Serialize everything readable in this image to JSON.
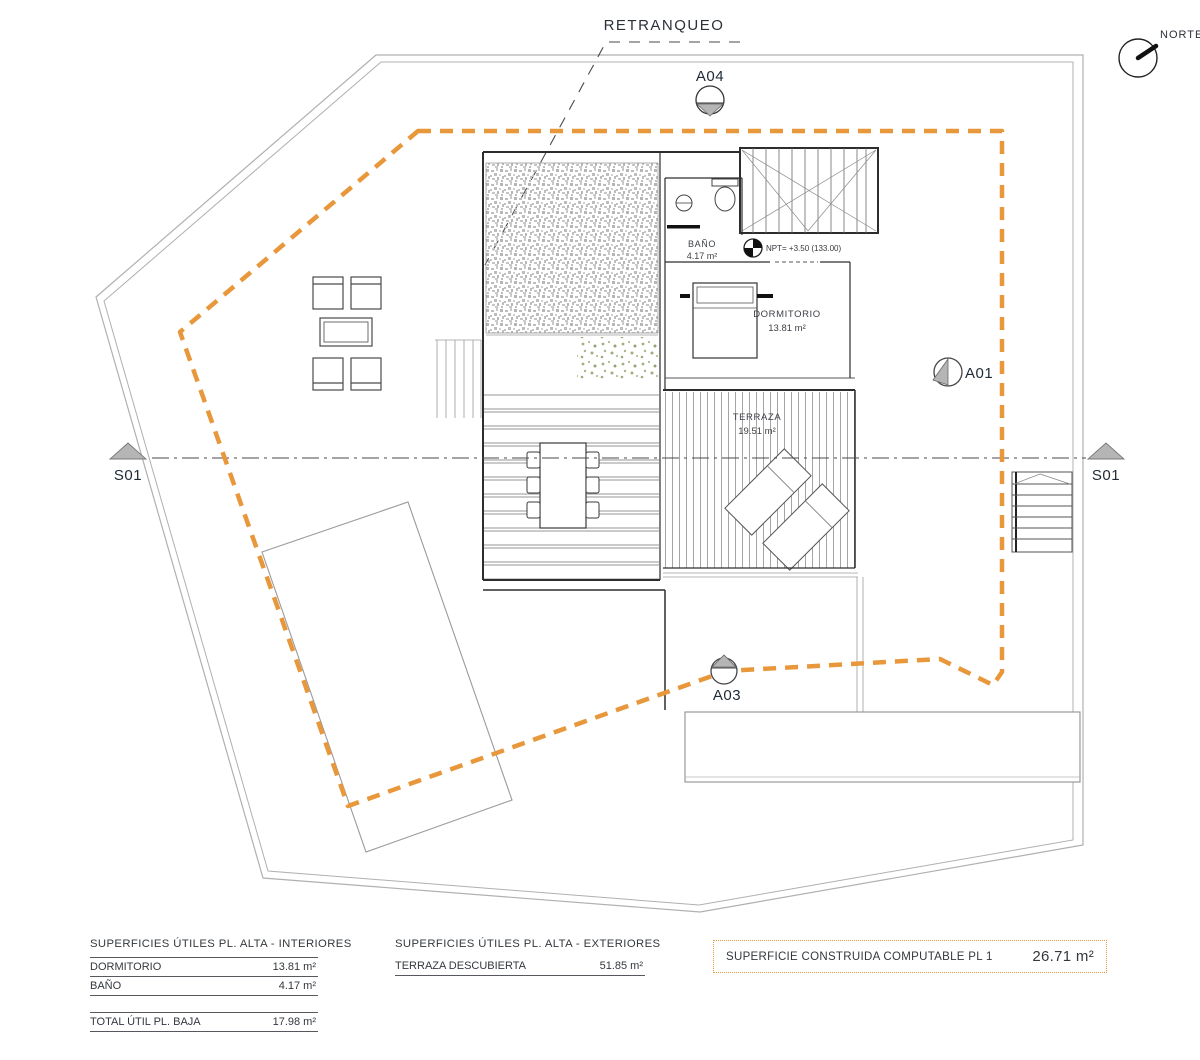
{
  "colors": {
    "accent": "#E8973A",
    "line_gray": "#b0b0b0",
    "wall_dark": "#2d2d2d"
  },
  "plan": {
    "retranqueo_label": "RETRANQUEO",
    "north_label": "NORTE",
    "markers": {
      "a04": "A04",
      "a01": "A01",
      "a03": "A03",
      "s01_left": "S01",
      "s01_right": "S01"
    },
    "level_note": "NPT= +3.50 (133.00)",
    "rooms": [
      {
        "name": "BAÑO",
        "area": "4.17 m²"
      },
      {
        "name": "DORMITORIO",
        "area": "13.81 m²"
      },
      {
        "name": "TERRAZA",
        "area": "19.51 m²"
      }
    ]
  },
  "tables": {
    "interiors": {
      "title": "SUPERFICIES ÚTILES PL. ALTA - INTERIORES",
      "rows": [
        {
          "label": "DORMITORIO",
          "value": "13.81 m²"
        },
        {
          "label": "BAÑO",
          "value": "4.17 m²"
        }
      ],
      "total": {
        "label": "TOTAL ÚTIL PL. BAJA",
        "value": "17.98 m²"
      }
    },
    "exteriors": {
      "title": "SUPERFICIES ÚTILES PL. ALTA - EXTERIORES",
      "rows": [
        {
          "label": "TERRAZA DESCUBIERTA",
          "value": "51.85 m²"
        }
      ]
    },
    "computable": {
      "label": "SUPERFICIE CONSTRUIDA COMPUTABLE PL 1",
      "value": "26.71 m²"
    }
  }
}
